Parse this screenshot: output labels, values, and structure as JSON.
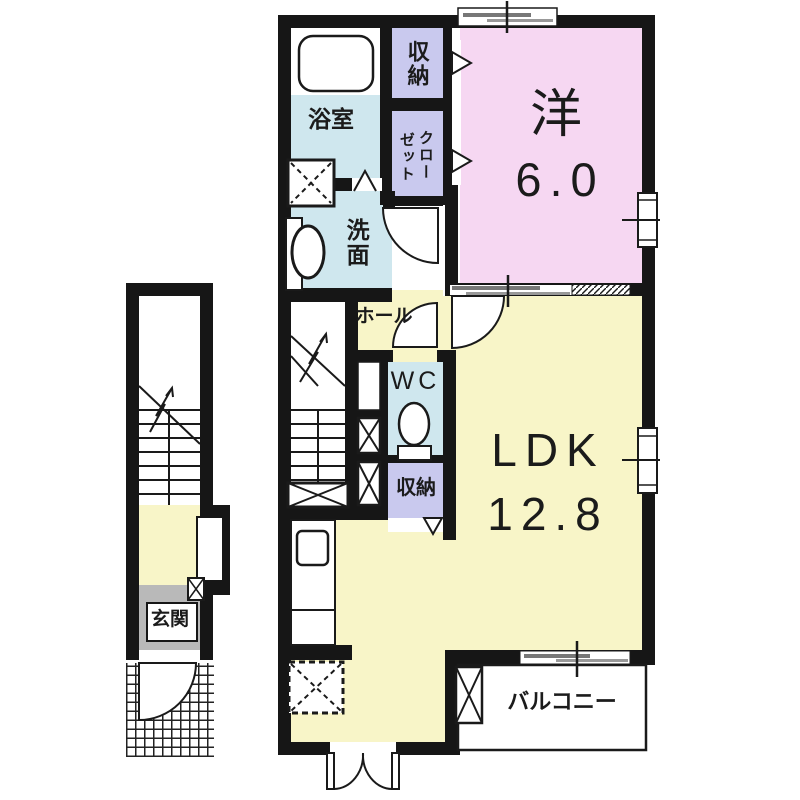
{
  "plan_type": "floor-plan",
  "palette": {
    "wall": "#161616",
    "western_room": "#f6d7f2",
    "ldk": "#f8f5c8",
    "wet_rooms": "#cfe7ee",
    "storage": "#c9c9ee",
    "entrance_gray": "#b9b9b9",
    "line": "#1a1a1a",
    "slide_bar_dark": "#777777",
    "slide_bar_light": "#999999"
  },
  "rooms": {
    "western": {
      "label": "洋",
      "area": "6.0"
    },
    "ldk": {
      "label": "LDK",
      "area": "12.8"
    },
    "bathroom": {
      "label": "浴室"
    },
    "washroom": {
      "label": "洗面"
    },
    "storage_top": {
      "label": "収納"
    },
    "closet": {
      "label": "クローゼット",
      "label_lines": [
        "クロー",
        "ゼット"
      ]
    },
    "hall": {
      "label": "ホール"
    },
    "wc": {
      "label": "WC"
    },
    "storage_mid": {
      "label": "収納"
    },
    "balcony": {
      "label": "バルコニー"
    },
    "entrance": {
      "label": "玄関"
    }
  }
}
